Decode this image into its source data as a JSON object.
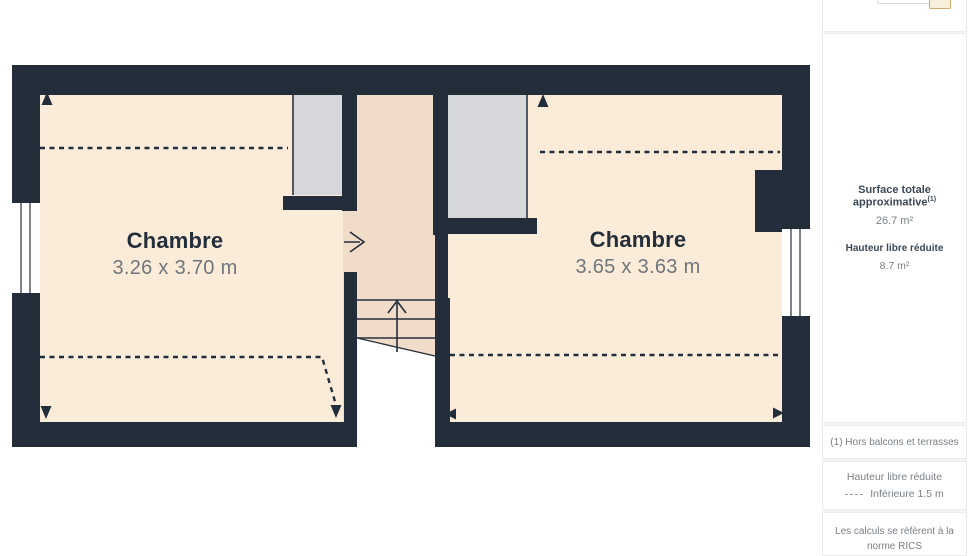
{
  "colors": {
    "wall": "#242e3b",
    "room_fill": "#fbecd9",
    "corridor_fill": "#f1dcc9",
    "closet_fill": "#d5d7da",
    "dashed_line": "#242e3b",
    "accent_tan": "#cfa96e",
    "label_dark": "#242e3b",
    "label_gray": "#70757b"
  },
  "floorplan": {
    "rooms": [
      {
        "name": "Chambre",
        "dimensions": "3.26 x 3.70 m"
      },
      {
        "name": "Chambre",
        "dimensions": "3.65 x 3.63 m"
      }
    ]
  },
  "sidebar": {
    "surface": {
      "label": "Surface totale approximative",
      "footnote_marker": "(1)",
      "value": "26.7 m²"
    },
    "reduced_height": {
      "label": "Hauteur libre réduite",
      "value": "8.7 m²"
    },
    "footnote": "(1) Hors balcons et terrasses",
    "legend": {
      "title": "Hauteur libre réduite",
      "item": "Inférieure 1.5 m"
    },
    "disclaimer": {
      "line1": "Les calculs se réfèrent à la norme RICS",
      "line2": "IPMS 3C. Toutes les mesures sont"
    }
  }
}
